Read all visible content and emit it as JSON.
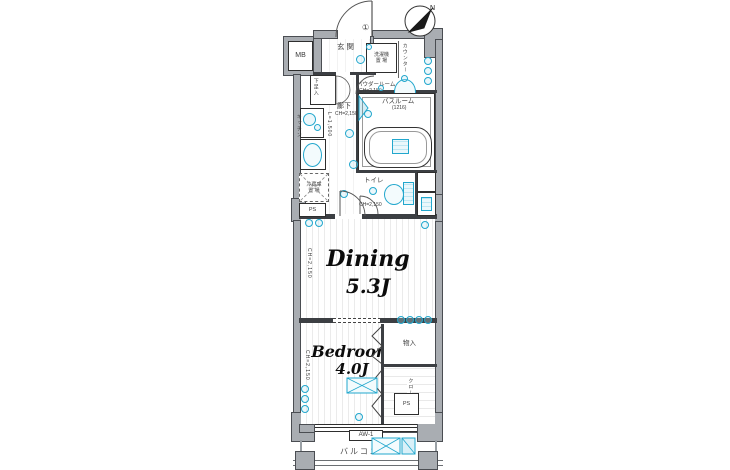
{
  "palette": {
    "wall_gray": "#a9adb2",
    "line_black": "#2e2e2e",
    "accent_cyan": "#22a7cd",
    "text_dark": "#3a3a3a"
  },
  "icons": {
    "compass": "north-arrow-compass",
    "entry_door": "door-swing-arc",
    "lights": "ceiling-light-circle",
    "stove": "stove-burner",
    "sink": "kitchen-sink",
    "basin": "wash-basin",
    "tub": "bathtub",
    "toilet_bowl": "toilet-bowl",
    "ac_unit": "air-conditioner-crossed-box",
    "outdoor_unit": "outdoor-unit-crossed-box"
  },
  "compass": {
    "label": "N"
  },
  "plan": {
    "entrance": {
      "label": "玄関",
      "door_tag": "①"
    },
    "mb": {
      "label": "MB"
    },
    "shoe_box": {
      "label": "下足入"
    },
    "laundry": {
      "line1": "洗濯機",
      "line2": "置 場"
    },
    "counter": {
      "label": "カウンター"
    },
    "powder": {
      "line1": "パウダールーム",
      "line2": "CH=2,150"
    },
    "corridor": {
      "label": "廊下",
      "ch": "CH=2,150"
    },
    "kitchen": {
      "label": "キッチン",
      "length": "L=1,500"
    },
    "fridge": {
      "line1": "冷蔵庫",
      "line2": "置 場"
    },
    "ps_upper": {
      "label": "PS"
    },
    "bathroom": {
      "line1": "バスルーム",
      "line2": "(1216)"
    },
    "toilet": {
      "label": "トイレ",
      "ch": "CH=2,150"
    },
    "dining": {
      "name": "Dining",
      "size": "5.3J",
      "ch": "CH=2,150"
    },
    "bedroom": {
      "name": "Bedroom",
      "size": "4.0J",
      "ch": "CH=2,150"
    },
    "storage": {
      "label": "物入"
    },
    "closet": {
      "label": "クローゼット"
    },
    "ps_lower": {
      "label": "PS"
    },
    "window": {
      "label": "AW-1"
    },
    "balcony": {
      "label": "バルコニー"
    }
  }
}
